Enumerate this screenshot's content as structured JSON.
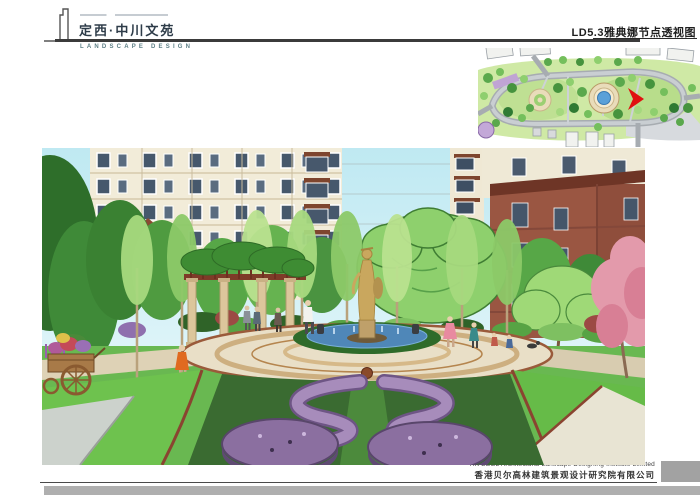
{
  "header": {
    "project_name": "定西·中川文苑",
    "logo_subtitle": "LANDSCAPE DESIGN",
    "sheet_title": "LD5.3雅典娜节点透视图"
  },
  "footer": {
    "company_en": "HK BEGL Architectural Lanscape Designing Institute Limited",
    "company_cn": "香港贝尔高林建筑景观设计研究院有限公司"
  },
  "colors": {
    "header_text": "#2e3c49",
    "logo_subtitle": "#5d7f86",
    "rule_dark": "#3b3b3b",
    "sheet_title_text": "#1f1f1f",
    "sky": "#c9ecf4",
    "lawn_green": "#6ec24e",
    "parterre_green": "#3a6b31",
    "flower_purple": "#8b6fa0",
    "water_blue": "#4f87b8",
    "statue_gold": "#c9a75e",
    "plan_marker_red": "#e01010",
    "footer_text": "#3f3f3f",
    "gray_box": "#a2a2a2",
    "bottom_bar_gray": "#afafaf"
  }
}
